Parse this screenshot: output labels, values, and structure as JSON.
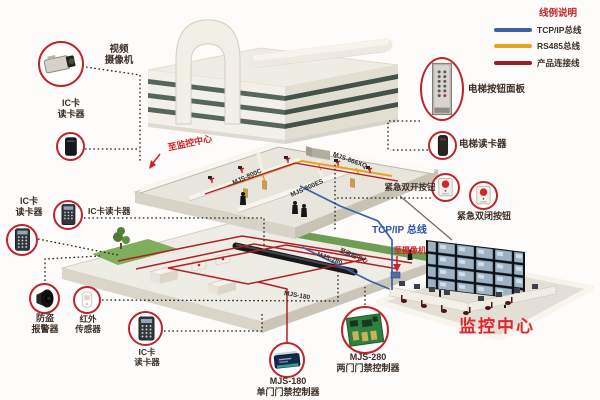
{
  "legend": {
    "title": "线例说明",
    "items": [
      {
        "name": "tcpip-bus-line",
        "label": "TCP/IP总线",
        "color": "#3a62a8"
      },
      {
        "name": "rs485-bus-line",
        "label": "RS485总线",
        "color": "#e6a41e"
      },
      {
        "name": "product-connect-line",
        "label": "产品连接线",
        "color": "#9e1b20"
      }
    ]
  },
  "labels": {
    "video_camera": "视频\n摄像机",
    "ic_reader_top": "IC卡\n读卡器",
    "ic_reader_left": "IC卡\n读卡器",
    "ic_reader_mid": "IC卡读卡器",
    "burglar_alarm": "防盗\n报警器",
    "ir_sensor": "红外\n传感器",
    "ic_reader_bottom": "IC卡\n读卡器",
    "controller_180": "MJS-180\n单门门禁控制器",
    "controller_280": "MJS-280\n两门门禁控制器",
    "elevator_panel": "电梯按钮面板",
    "elevator_reader": "电梯读卡器",
    "emergency_open": "紧急双开按钮",
    "emergency_close": "紧急双闭按钮",
    "to_monitor_center": "至监控中心",
    "to_camera": "至摄像机",
    "tcpip_bus": "TCP/IP 总线",
    "monitor_center": "监控中心",
    "model_866xq": "MJS-866XQ",
    "model_800c": "MJS-800C",
    "model_800es": "MJS-800ES",
    "model_280_small": "MJS-280",
    "model_180_small": "MJS-180",
    "to_monitor_small": "至监控中心"
  },
  "colors": {
    "callout_ring_red": "#c2232a",
    "label_text": "#3c2f26",
    "legend_title_red": "#c2262a",
    "tcpip_blue": "#3a62a8",
    "rs485_yellow": "#e6a41e",
    "product_line_red": "#9e1b20",
    "monitor_center_red": "#e4262c"
  }
}
